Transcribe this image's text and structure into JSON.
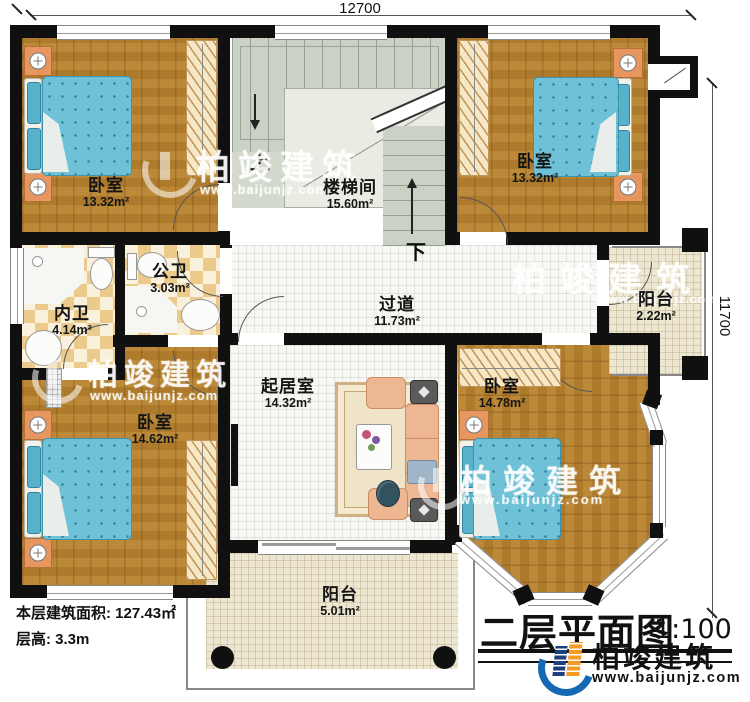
{
  "title_block": {
    "title": "二层平面图",
    "scale": "1:100"
  },
  "info": {
    "floor_area": "本层建筑面积: 127.43㎡",
    "floor_height": "层高: 3.3m"
  },
  "dimensions": {
    "top": "12700",
    "right": "11700"
  },
  "stairs": {
    "up": "上",
    "down": "下"
  },
  "rooms": [
    {
      "name": "卧室",
      "area": "13.32m²"
    },
    {
      "name": "楼梯间",
      "area": "15.60m²"
    },
    {
      "name": "卧室",
      "area": "13.32m²"
    },
    {
      "name": "内卫",
      "area": "4.14m²"
    },
    {
      "name": "公卫",
      "area": "3.03m²"
    },
    {
      "name": "过道",
      "area": "11.73m²"
    },
    {
      "name": "阳台",
      "area": "2.22m²"
    },
    {
      "name": "起居室",
      "area": "14.32m²"
    },
    {
      "name": "卧室",
      "area": "14.62m²"
    },
    {
      "name": "卧室",
      "area": "14.78m²"
    },
    {
      "name": "阳台",
      "area": "5.01m²"
    }
  ],
  "brand": {
    "name": "柏竣建筑",
    "website": "www.baijunjz.com"
  },
  "watermark": {
    "name": "柏竣建筑",
    "website": "www.baijunjz.com"
  },
  "colors": {
    "wall": "#101010",
    "wood": "#b5812f",
    "bed": "#6ec1d6",
    "tile": "#ecca8c",
    "stair": "#c9d2c5",
    "balcony_floor": "#ede7d2",
    "logo_blue": "#1569b3",
    "logo_navy": "#1d3f7d",
    "logo_orange": "#f59a23"
  }
}
